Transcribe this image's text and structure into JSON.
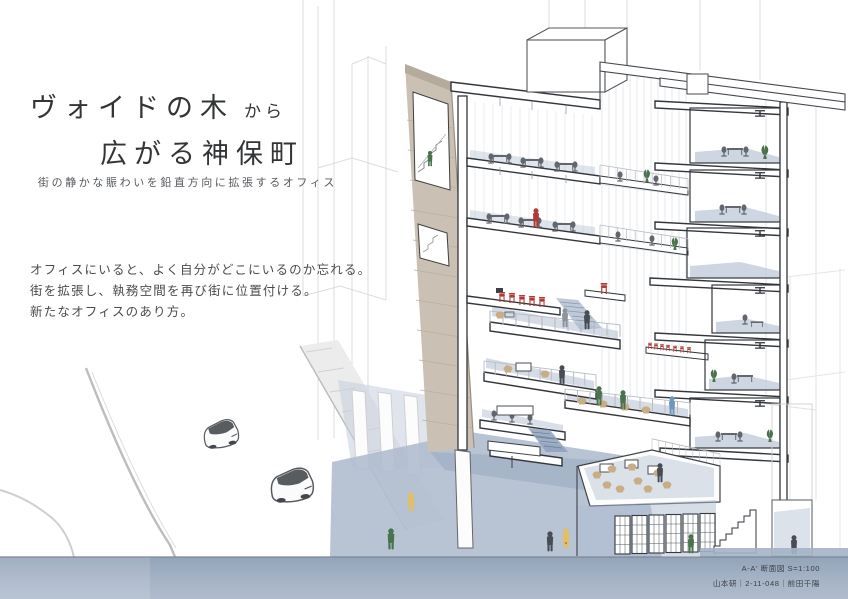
{
  "title": {
    "main": "ヴォイドの木",
    "connector": "から",
    "second": "広がる神保町"
  },
  "subtitle": "街の静かな賑わいを鉛直方向に拡張するオフィス",
  "statement": [
    "オフィスにいると、よく自分がどこにいるのか忘れる。",
    "街を拡張し、執務空間を再び街に位置付ける。",
    "新たなオフィスのあり方。"
  ],
  "caption": {
    "drawing_label": "A-A' 断面図 S=1:100",
    "credit": "山本研｜2-11-048｜前田千陽"
  },
  "drawing": {
    "type": "architectural-section-perspective",
    "scene": {
      "building": "multi-story office cut in section with cascading interior terraces around a vertical void",
      "street": "sloping road with two sketched cars and pedestrians",
      "lower_level": "sunken book-shelf terrace with cafe seating and stair"
    },
    "colors": {
      "accent_red": "#b43a31",
      "accent_green": "#49724d",
      "wall_tan": "#cac1b4",
      "wash_blue": "#b9c5d5",
      "plaza_blue": "#b0bdcf",
      "ground_blue": "#9dadc2",
      "furniture_tan": "#c9ae85",
      "figure_dark": "#474c55",
      "figure_blue": "#6f97bb",
      "figure_yellow": "#e3c05c",
      "line_dark": "#33373c",
      "line_faint": "#d8d8d8"
    }
  }
}
